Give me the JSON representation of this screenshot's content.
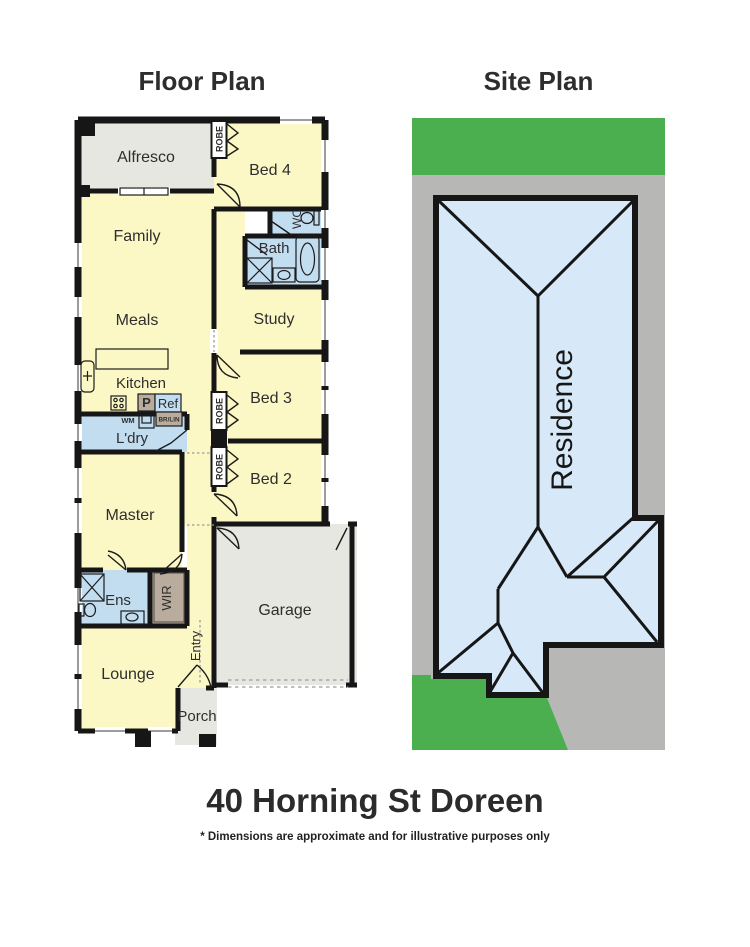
{
  "header": {
    "floor_plan_title": "Floor Plan",
    "site_plan_title": "Site Plan"
  },
  "footer": {
    "address": "40 Horning St Doreen",
    "disclaimer": "* Dimensions are approximate and for illustrative purposes only"
  },
  "floor_plan": {
    "rooms": {
      "alfresco": "Alfresco",
      "bed4": "Bed 4",
      "family": "Family",
      "meals": "Meals",
      "kitchen": "Kitchen",
      "wc": "WC",
      "bath": "Bath",
      "study": "Study",
      "bed3": "Bed 3",
      "bed2": "Bed 2",
      "ldry": "L'dry",
      "master": "Master",
      "ens": "Ens",
      "wir": "WIR",
      "entry": "Entry",
      "lounge": "Lounge",
      "garage": "Garage",
      "porch": "Porch"
    },
    "fixtures": {
      "robe": "ROBE",
      "pantry": "P",
      "fridge": "Ref",
      "washing_machine": "WM",
      "broom_linen": "BR/LIN"
    }
  },
  "site_plan": {
    "residence": "Residence"
  },
  "colors": {
    "room_yellow": "#fcf8c5",
    "wet_blue": "#c3ddf0",
    "robe_brown": "#b9ac9d",
    "outdoor_gray": "#e7e7e1",
    "wall_black": "#161616",
    "grass_green": "#4bae4f",
    "lot_gray": "#b7b7b5",
    "residence_blue": "#d7e9f8"
  }
}
